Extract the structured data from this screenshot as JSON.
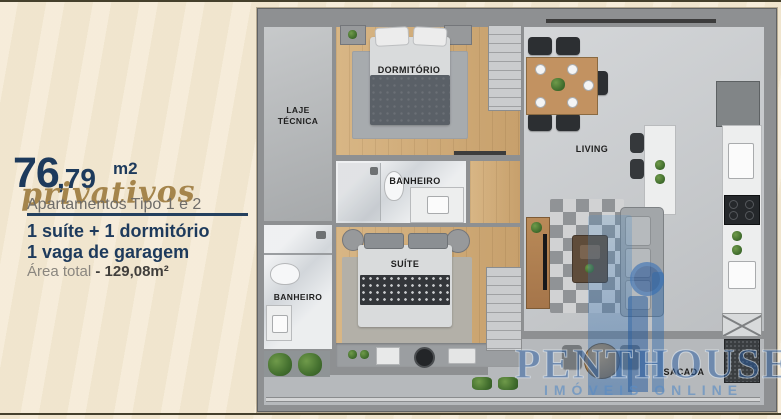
{
  "info_panel": {
    "area_int": "76",
    "area_dec": ",79",
    "area_unit": "m2",
    "area_qualifier": "privativos",
    "subtitle": "Apartamentos Tipo 1 e 2",
    "feature_1": "1 suíte + 1 dormitório",
    "feature_2": "1 vaga de garagem",
    "total_label": "Área total",
    "total_value": "- 129,08m²"
  },
  "floor_plan": {
    "labels": {
      "laje": "LAJE TÉCNICA",
      "dormitorio": "DORMITÓRIO",
      "banheiro_social": "BANHEIRO",
      "banheiro_suite": "BANHEIRO",
      "suite": "SUÍTE",
      "living": "LIVING",
      "sacada": "SACADA"
    }
  },
  "watermark": {
    "brand": "PENTHOUSE",
    "tagline": "IMÓVEIS ONLINE"
  },
  "colors": {
    "background": "#f4e9d3",
    "frame_line": "#45402c",
    "navy": "#1d3a5c",
    "gold": "#a5854c",
    "gray_text": "#6f6d6a",
    "wall_gray": "#8e9092",
    "wood_floor": "#cfab79",
    "watermark_blue": "#2b5ea0"
  }
}
